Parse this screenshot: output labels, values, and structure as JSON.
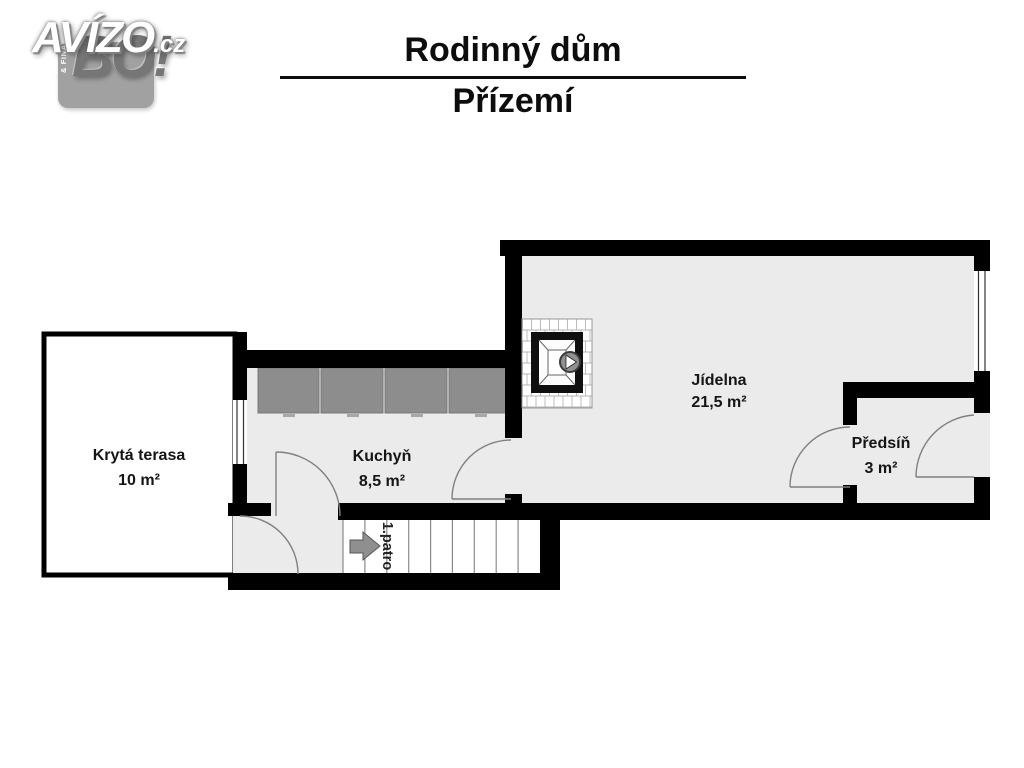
{
  "logo": {
    "brand": "AVÍZO",
    "domain_suffix": ".cz",
    "badge_text": "BO!",
    "badge_tagline_line1": "REALITY",
    "badge_tagline_line2": "& FINANCE"
  },
  "header": {
    "title": "Rodinný dům",
    "subtitle": "Přízemí"
  },
  "floorplan": {
    "rooms": {
      "terrace": {
        "name": "Krytá terasa",
        "area": "10 m²"
      },
      "kitchen": {
        "name": "Kuchyň",
        "area": "8,5 m²"
      },
      "dining": {
        "name": "Jídelna",
        "area": "21,5 m²"
      },
      "hallway": {
        "name": "Předsíň",
        "area": "3 m²"
      }
    },
    "stairs": {
      "direction_label": "1.patro"
    },
    "colors": {
      "wall": "#000000",
      "floor": "#ebebeb",
      "counter": "#8d8d8d",
      "stair_arrow": "#8f8f8f",
      "door_arc": "#808080"
    }
  }
}
